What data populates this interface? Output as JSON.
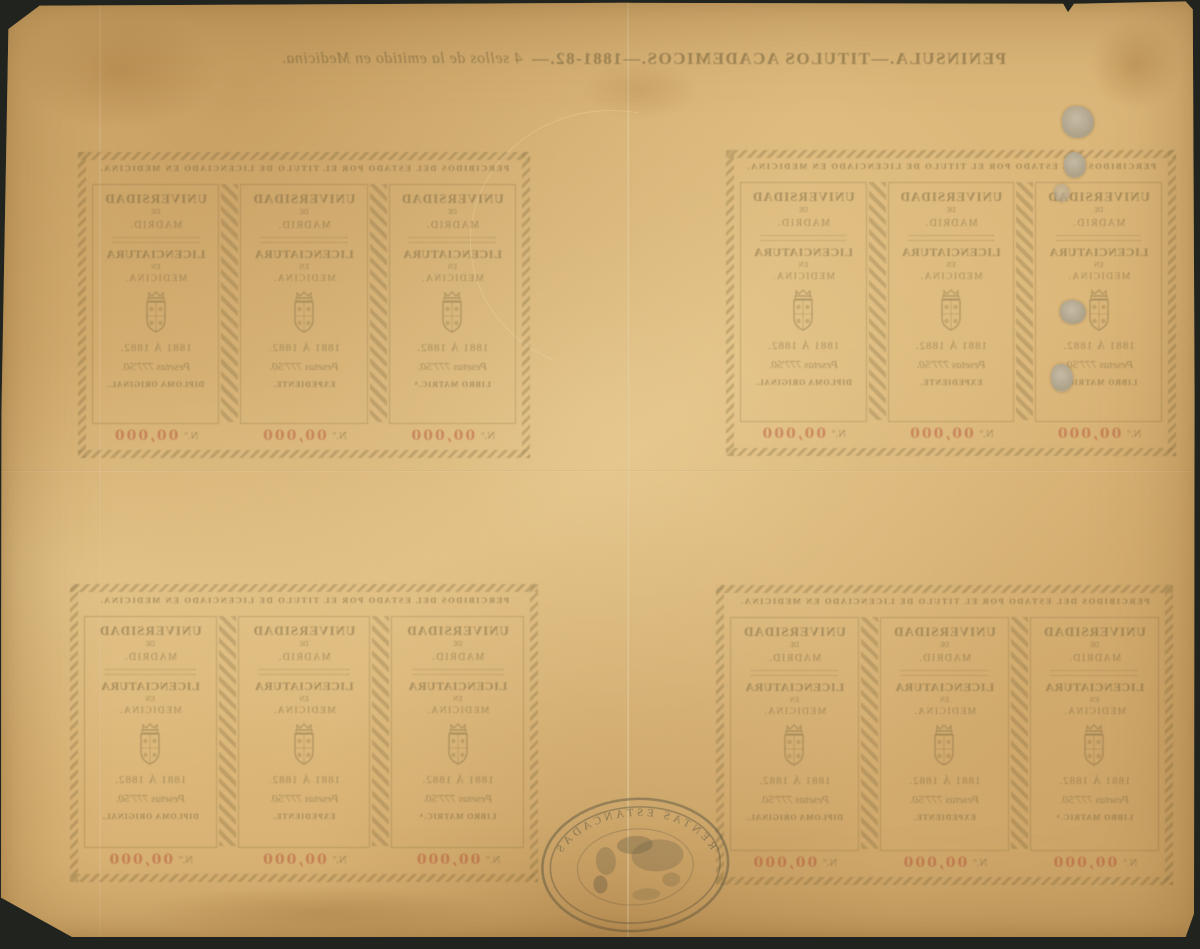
{
  "colors": {
    "background": "#20231e",
    "paper": "#dcb87b",
    "ink_olive": "#6e5f38",
    "number_red": "#b04832",
    "seal_ink": "#4c4c3c",
    "adhesive_patch_grey": "#b7af9d"
  },
  "sheet_header": {
    "series": "PENINSULA.—TITULOS ACADEMICOS.—1881-82.—",
    "description": "4 sellos de la emitido en Medicina."
  },
  "block": {
    "banner": "PERCIBIDOS DEL ESTADO POR EL TITULO DE LICENCIADO EN MEDICINA.",
    "stamps": [
      {
        "org": "UNIVERSIDAD",
        "org_de": "DE",
        "org_city": "MADRID.",
        "degree": "LICENCIATURA",
        "degree_en": "EN",
        "degree_field": "MEDICINA.",
        "years": "1881 Á 1882.",
        "value": "Pesetas 777'50.",
        "doc_type": "LIBRO MATRIC.ᴬ",
        "number_label": "N.º",
        "number": "00,000"
      },
      {
        "org": "UNIVERSIDAD",
        "org_de": "DE",
        "org_city": "MADRID.",
        "degree": "LICENCIATURA",
        "degree_en": "EN",
        "degree_field": "MEDICINA.",
        "years": "1881 Á 1882.",
        "value": "Pesetas 777'50.",
        "doc_type": "EXPEDIENTE.",
        "number_label": "N.º",
        "number": "00,000"
      },
      {
        "org": "UNIVERSIDAD",
        "org_de": "DE",
        "org_city": "MADRID.",
        "degree": "LICENCIATURA",
        "degree_en": "EN",
        "degree_field": "MEDICINA.",
        "years": "1881 Á 1882.",
        "value": "Pesetas 777'50.",
        "doc_type": "DIPLOMA ORIGINAL.",
        "number_label": "N.º",
        "number": "00,000"
      }
    ]
  },
  "seal": {
    "rim_top": "RENTAS ESTANCADAS"
  },
  "icons": {
    "coat_of_arms": "spanish-royal-arms-icon",
    "oval_handstamp": "rentas-estancadas-seal-icon"
  }
}
